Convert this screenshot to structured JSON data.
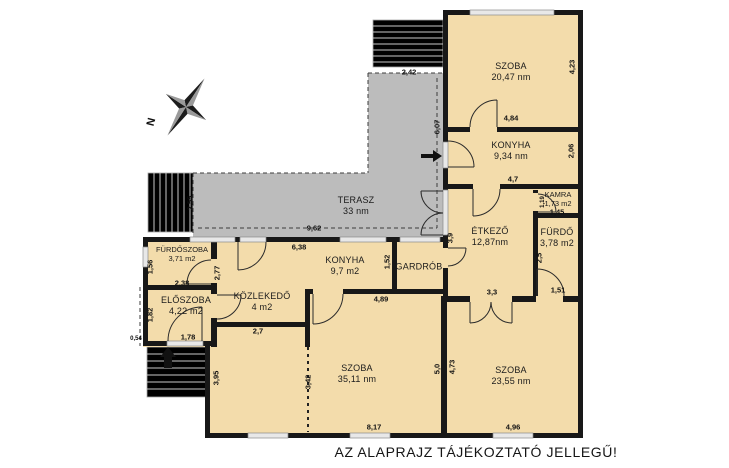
{
  "note": "AZ ALAPRAJZ TÁJÉKOZTATÓ JELLEGŰ!",
  "compass": {
    "label": "N"
  },
  "colors": {
    "wall": "#181818",
    "room_fill": "#f3dcab",
    "terrace_fill": "#bcbcbc",
    "window_fill": "#e8e8e8",
    "stairs_fill": "#f7f7f7",
    "door_stroke": "#2b2b2b"
  },
  "rooms": [
    {
      "id": "szoba-nagy",
      "name": "SZOBA",
      "area": "20,47 nm",
      "x": 511,
      "y": 67,
      "small": false
    },
    {
      "id": "konyha-felso",
      "name": "KONYHA",
      "area": "9,34 nm",
      "x": 511,
      "y": 146,
      "small": false
    },
    {
      "id": "kamra",
      "name": "KAMRA",
      "area": "1,73 m2",
      "x": 558,
      "y": 194,
      "small": true
    },
    {
      "id": "furdo",
      "name": "FÜRDŐ",
      "area": "3,78 m2",
      "x": 557,
      "y": 233,
      "small": false
    },
    {
      "id": "etkezo",
      "name": "ÉTKEZŐ",
      "area": "12,87nm",
      "x": 490,
      "y": 232,
      "small": false
    },
    {
      "id": "gardrob",
      "name": "GARDRÓB",
      "area": "",
      "x": 419,
      "y": 267,
      "small": false
    },
    {
      "id": "konyha-also",
      "name": "KONYHA",
      "area": "9,7 m2",
      "x": 345,
      "y": 261,
      "small": false
    },
    {
      "id": "kozlekedo",
      "name": "KÖZLEKEDŐ",
      "area": "4 m2",
      "x": 262,
      "y": 297,
      "small": false
    },
    {
      "id": "furdoszoba",
      "name": "FÜRDŐSZOBA",
      "area": "3,71 m2",
      "x": 182,
      "y": 249,
      "small": true
    },
    {
      "id": "eloszoba",
      "name": "ELŐSZOBA",
      "area": "4,22 m2",
      "x": 186,
      "y": 301,
      "small": false
    },
    {
      "id": "terasz",
      "name": "TERASZ",
      "area": "33 nm",
      "x": 356,
      "y": 201,
      "small": false
    },
    {
      "id": "szoba-kozep",
      "name": "SZOBA",
      "area": "35,11 nm",
      "x": 357,
      "y": 369,
      "small": false
    },
    {
      "id": "szoba-jobb",
      "name": "SZOBA",
      "area": "23,55 nm",
      "x": 511,
      "y": 371,
      "small": false
    }
  ],
  "dimensions": [
    {
      "id": "dim-2-42",
      "value": "2,42",
      "x": 409,
      "y": 72,
      "vertical": false,
      "tiny": false
    },
    {
      "id": "dim-4-84",
      "value": "4,84",
      "x": 511,
      "y": 118,
      "vertical": false,
      "tiny": false
    },
    {
      "id": "dim-4-7",
      "value": "4,7",
      "x": 513,
      "y": 179,
      "vertical": false,
      "tiny": false
    },
    {
      "id": "dim-1-45",
      "value": "1,45",
      "x": 557,
      "y": 212,
      "vertical": false,
      "tiny": false
    },
    {
      "id": "dim-9-62",
      "value": "9,62",
      "x": 314,
      "y": 228,
      "vertical": false,
      "tiny": false
    },
    {
      "id": "dim-6-38",
      "value": "6,38",
      "x": 299,
      "y": 247,
      "vertical": false,
      "tiny": false
    },
    {
      "id": "dim-1-51",
      "value": "1,51",
      "x": 558,
      "y": 290,
      "vertical": false,
      "tiny": false
    },
    {
      "id": "dim-3-3",
      "value": "3,3",
      "x": 492,
      "y": 292,
      "vertical": false,
      "tiny": false
    },
    {
      "id": "dim-4-89",
      "value": "4,89",
      "x": 381,
      "y": 299,
      "vertical": false,
      "tiny": false
    },
    {
      "id": "dim-2-38",
      "value": "2,38",
      "x": 182,
      "y": 283,
      "vertical": false,
      "tiny": false
    },
    {
      "id": "dim-1-78",
      "value": "1,78",
      "x": 188,
      "y": 337,
      "vertical": false,
      "tiny": false
    },
    {
      "id": "dim-0-54",
      "value": "0,54",
      "x": 136,
      "y": 339,
      "vertical": false,
      "tiny": true
    },
    {
      "id": "dim-2-7",
      "value": "2,7",
      "x": 258,
      "y": 331,
      "vertical": false,
      "tiny": false
    },
    {
      "id": "dim-8-17",
      "value": "8,17",
      "x": 374,
      "y": 427,
      "vertical": false,
      "tiny": false
    },
    {
      "id": "dim-4-96",
      "value": "4,96",
      "x": 513,
      "y": 427,
      "vertical": false,
      "tiny": false
    },
    {
      "id": "dim-4-23",
      "value": "4,23",
      "x": 572,
      "y": 67,
      "vertical": true,
      "tiny": false
    },
    {
      "id": "dim-2-06",
      "value": "2,06",
      "x": 571,
      "y": 151,
      "vertical": true,
      "tiny": false
    },
    {
      "id": "dim-6-07",
      "value": "6,07",
      "x": 437,
      "y": 127,
      "vertical": true,
      "tiny": false
    },
    {
      "id": "dim-1-19",
      "value": "1,19",
      "x": 543,
      "y": 202,
      "vertical": true,
      "tiny": true
    },
    {
      "id": "dim-2-5",
      "value": "2,5",
      "x": 539,
      "y": 258,
      "vertical": true,
      "tiny": false
    },
    {
      "id": "dim-2-55",
      "value": "2,55",
      "x": 190,
      "y": 203,
      "vertical": true,
      "tiny": false
    },
    {
      "id": "dim-3-9",
      "value": "3,9",
      "x": 450,
      "y": 238,
      "vertical": true,
      "tiny": false
    },
    {
      "id": "dim-1-52",
      "value": "1,52",
      "x": 387,
      "y": 262,
      "vertical": true,
      "tiny": false
    },
    {
      "id": "dim-2-77",
      "value": "2,77",
      "x": 217,
      "y": 273,
      "vertical": true,
      "tiny": false
    },
    {
      "id": "dim-1-56",
      "value": "1,56",
      "x": 150,
      "y": 267,
      "vertical": true,
      "tiny": false
    },
    {
      "id": "dim-1-82",
      "value": "1,82",
      "x": 150,
      "y": 315,
      "vertical": true,
      "tiny": false
    },
    {
      "id": "dim-3-95",
      "value": "3,95",
      "x": 216,
      "y": 378,
      "vertical": true,
      "tiny": false
    },
    {
      "id": "dim-3-42",
      "value": "3,42",
      "x": 308,
      "y": 382,
      "vertical": true,
      "tiny": false
    },
    {
      "id": "dim-5-0",
      "value": "5,0",
      "x": 437,
      "y": 369,
      "vertical": true,
      "tiny": false
    },
    {
      "id": "dim-4-73",
      "value": "4,73",
      "x": 452,
      "y": 367,
      "vertical": true,
      "tiny": false
    }
  ]
}
